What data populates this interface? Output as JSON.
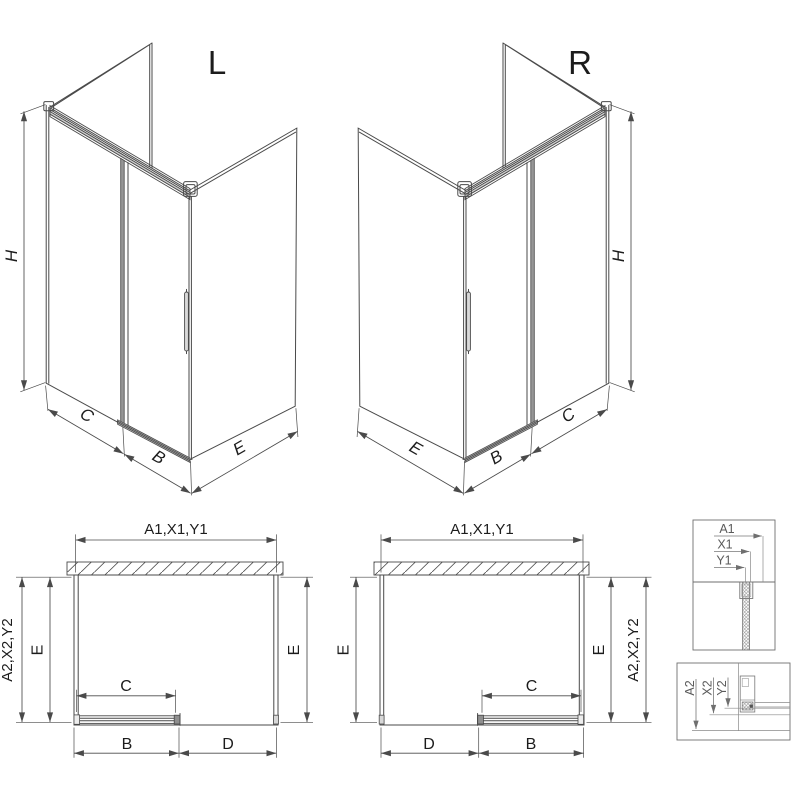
{
  "drawing": {
    "background": "#ffffff",
    "line_color": "#4a4a4a",
    "door_fill": "#969696",
    "views": {
      "iso_left": {
        "title": "L",
        "dims": {
          "height": "H",
          "fixed_width": "C",
          "door_width": "B",
          "side_depth": "E"
        }
      },
      "iso_right": {
        "title": "R",
        "dims": {
          "height": "H",
          "fixed_width": "C",
          "door_width": "B",
          "side_depth": "E"
        }
      },
      "plan_left": {
        "dims": {
          "top": "A1,X1,Y1",
          "outer_left": "A2,X2,Y2",
          "inner_left": "E",
          "right": "E",
          "door_opening": "C",
          "bottom_left": "B",
          "bottom_right": "D"
        }
      },
      "plan_right": {
        "dims": {
          "top": "A1,X1,Y1",
          "left": "E",
          "inner_right": "E",
          "outer_right": "A2,X2,Y2",
          "door_opening": "C",
          "bottom_left": "D",
          "bottom_right": "B"
        }
      },
      "detail_top": {
        "labels": {
          "a1": "A1",
          "x1": "X1",
          "y1": "Y1"
        }
      },
      "detail_bottom": {
        "labels": {
          "a2": "A2",
          "x2": "X2",
          "y2": "Y2"
        }
      }
    }
  }
}
